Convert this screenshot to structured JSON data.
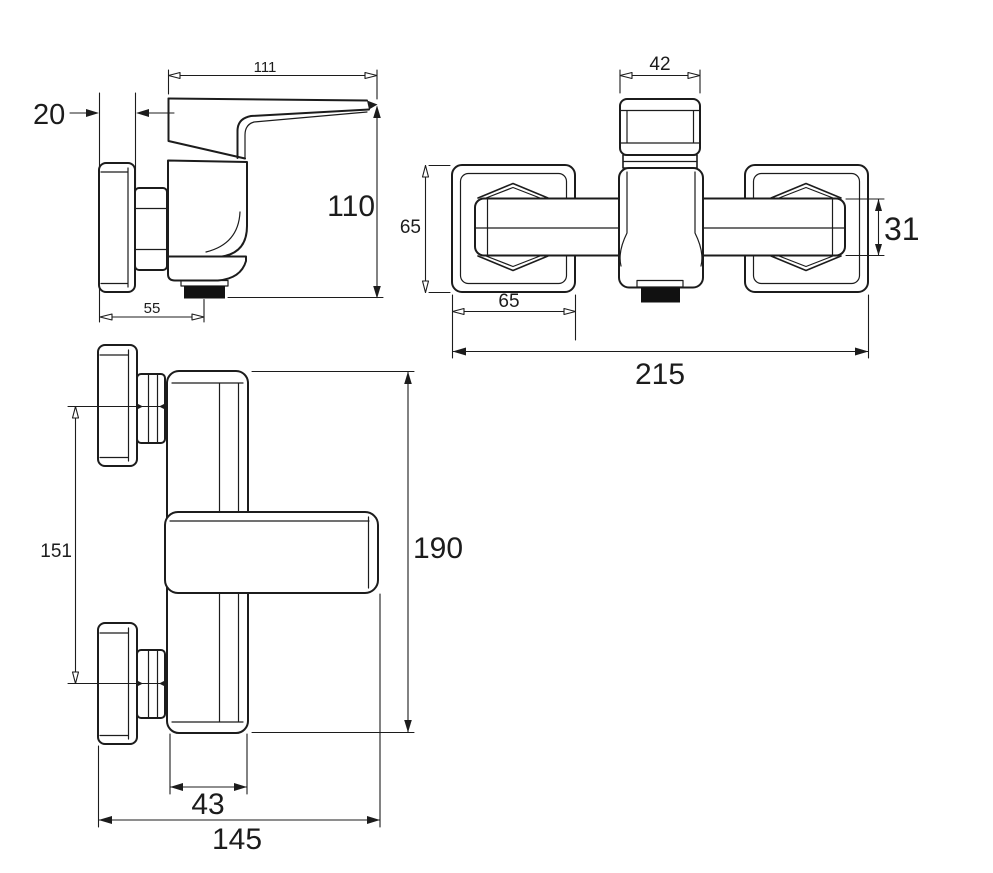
{
  "drawing": {
    "type": "technical dimensional drawing",
    "subject": "wall-mounted single-lever shower mixer tap, three orthographic views",
    "units": "mm",
    "colors": {
      "background": "#ffffff",
      "line": "#1c1c1c",
      "spout": "#111111"
    }
  },
  "views": {
    "side": {
      "name": "side view",
      "dims": {
        "width": {
          "label": "111"
        },
        "wall_thickness": {
          "label": "20"
        },
        "height": {
          "label": "110"
        },
        "spout_offset": {
          "label": "55"
        }
      }
    },
    "top": {
      "name": "top view",
      "dims": {
        "handle_width": {
          "label": "42"
        },
        "escutcheon_height": {
          "label": "65"
        },
        "bar_height": {
          "label": "31"
        },
        "escutcheon_width": {
          "label": "65"
        },
        "overall_width": {
          "label": "215"
        }
      }
    },
    "front": {
      "name": "front view",
      "dims": {
        "supply_centres": {
          "label": "151"
        },
        "overall_height": {
          "label": "190"
        },
        "body_width": {
          "label": "43"
        },
        "overall_width": {
          "label": "145"
        }
      }
    }
  }
}
